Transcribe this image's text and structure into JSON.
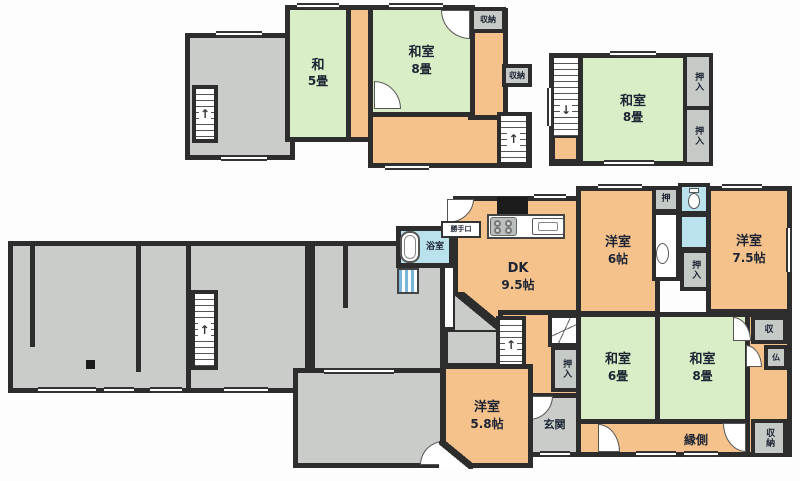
{
  "colors": {
    "wall": "#2d2d2d",
    "green": "#d9eec6",
    "orange": "#f5c28c",
    "gray": "#c9ccc8",
    "closet": "#c6cac6",
    "blue": "#b9e2ec",
    "text": "#1c2433"
  },
  "icons": {
    "stair_up": "↑",
    "stair_down": "↓"
  },
  "floor2": {
    "room_wa5": {
      "name": "和",
      "size": "5畳"
    },
    "room_washitsu8_left": {
      "name": "和室",
      "size": "8畳"
    },
    "room_washitsu8_right": {
      "name": "和室",
      "size": "8畳"
    },
    "storage_top": "収納",
    "storage_side": "収納",
    "closet_upper": "押入",
    "closet_lower": "押入"
  },
  "floor1": {
    "room_dk": {
      "name": "DK",
      "size": "9.5帖"
    },
    "room_yoshitsu6": {
      "name": "洋室",
      "size": "6帖"
    },
    "room_yoshitsu75": {
      "name": "洋室",
      "size": "7.5帖"
    },
    "room_washitsu6": {
      "name": "和室",
      "size": "6畳"
    },
    "room_washitsu8": {
      "name": "和室",
      "size": "8畳"
    },
    "room_yoshitsu58": {
      "name": "洋室",
      "size": "5.8帖"
    },
    "bath": "浴室",
    "back_door": "勝手口",
    "closet_small": "押",
    "closet_wash": "押入",
    "closet_hall": "押入",
    "entrance": "玄関",
    "veranda": "縁側",
    "storage_top_right": "収",
    "altar": "仏",
    "storage_bottom_right": "収納"
  }
}
